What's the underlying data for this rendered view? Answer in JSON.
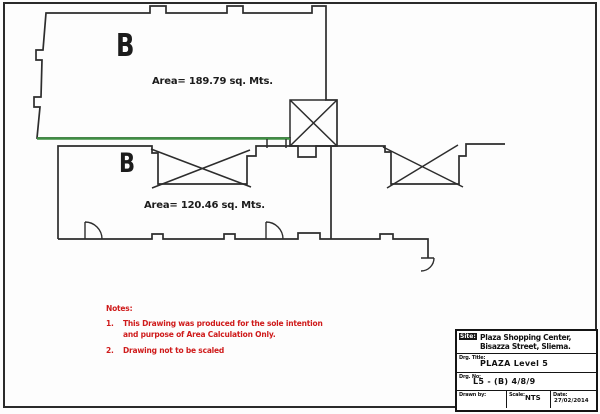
{
  "plans": {
    "upper": {
      "label": "B",
      "area_text": "Area= 189.79 sq. Mts."
    },
    "lower": {
      "label": "B",
      "area_text": "Area= 120.46 sq. Mts."
    }
  },
  "notes": {
    "heading": "Notes:",
    "items": [
      {
        "num": "1.",
        "lines": [
          "This Drawing was produced for the sole intention",
          "and purpose of Area Calculation Only."
        ]
      },
      {
        "num": "2.",
        "lines": [
          "Drawing not to be scaled"
        ]
      }
    ]
  },
  "title_block": {
    "site_label": "Site:",
    "site_line1": "Plaza Shopping Center,",
    "site_line2": "Bisazza Street, Sliema.",
    "drg_title_label": "Drg. Title:",
    "drg_title": "PLAZA Level  5",
    "drg_no_label": "Drg. No:",
    "drg_no": "L5 - (B) 4/8/9",
    "drawn_by_label": "Drawn by:",
    "scale_label": "Scale:",
    "scale_value": "NTS",
    "date_label": "Date:",
    "date_value": "27/02/2014"
  },
  "colors": {
    "outline": "#2d2d2d",
    "upper_accent_green": "#3f8f43",
    "notes_red": "#cf1b1b"
  }
}
